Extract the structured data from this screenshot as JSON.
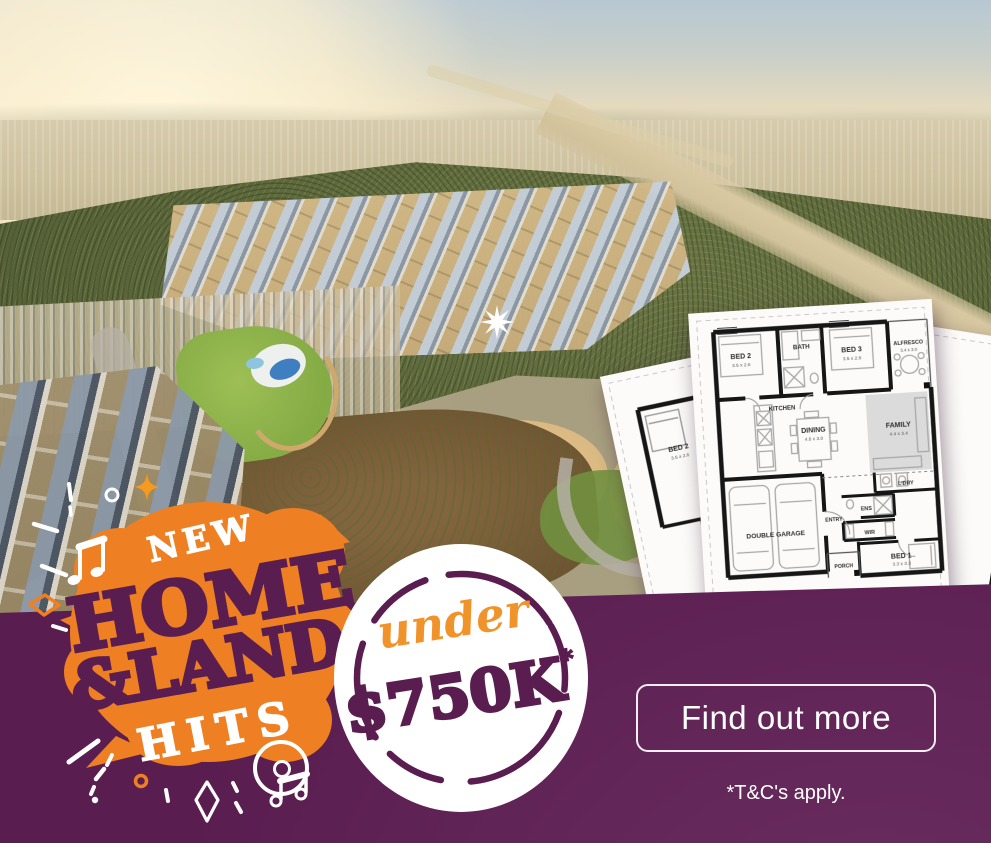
{
  "banner": {
    "badge": {
      "eyebrow": "NEW",
      "title_line1": "HOME",
      "title_line2": "&LAND",
      "title_line3": "HITS"
    },
    "offer": {
      "qualifier": "under",
      "price": "$750K",
      "disclaimer_mark": "*"
    },
    "cta": {
      "label": "Find out more"
    },
    "terms": "*T&C's apply."
  },
  "floor_plan": {
    "main_rooms": [
      {
        "name": "BED 2",
        "dims": "3.5 x 2.6"
      },
      {
        "name": "BATH",
        "dims": ""
      },
      {
        "name": "BED 3",
        "dims": "3.5 x 2.6"
      },
      {
        "name": "ALFRESCO",
        "dims": "3.4 x 3.0"
      },
      {
        "name": "KITCHEN",
        "dims": ""
      },
      {
        "name": "DINING",
        "dims": "4.6 x 3.0"
      },
      {
        "name": "FAMILY",
        "dims": "4.4 x 3.4"
      },
      {
        "name": "DOUBLE GARAGE",
        "dims": ""
      },
      {
        "name": "L'DRY",
        "dims": ""
      },
      {
        "name": "ENS",
        "dims": ""
      },
      {
        "name": "WIR",
        "dims": ""
      },
      {
        "name": "ENTRY",
        "dims": ""
      },
      {
        "name": "PORCH",
        "dims": ""
      },
      {
        "name": "BED 1",
        "dims": "3.3 x 3.3"
      }
    ],
    "left_sheet_rooms": [
      {
        "name": "BED 2",
        "dims": "3.5 x 2.6"
      }
    ],
    "right_sheet_rooms": [
      {
        "name": "ALFRESCO",
        "dims": "3.4 x 3.0"
      },
      {
        "name": "FAMILY",
        "dims": "4.4 x 3.4"
      },
      {
        "name": "L'DRY",
        "dims": ""
      }
    ]
  },
  "icons": [
    "star-burst",
    "sparkle",
    "music-notes",
    "vinyl-record",
    "diamond-outline",
    "confetti-dashes",
    "confetti-dots"
  ],
  "colors": {
    "brand_purple": "#5a1d50",
    "brand_orange": "#ee8023",
    "script_orange": "#f0932a",
    "white": "#ffffff"
  }
}
